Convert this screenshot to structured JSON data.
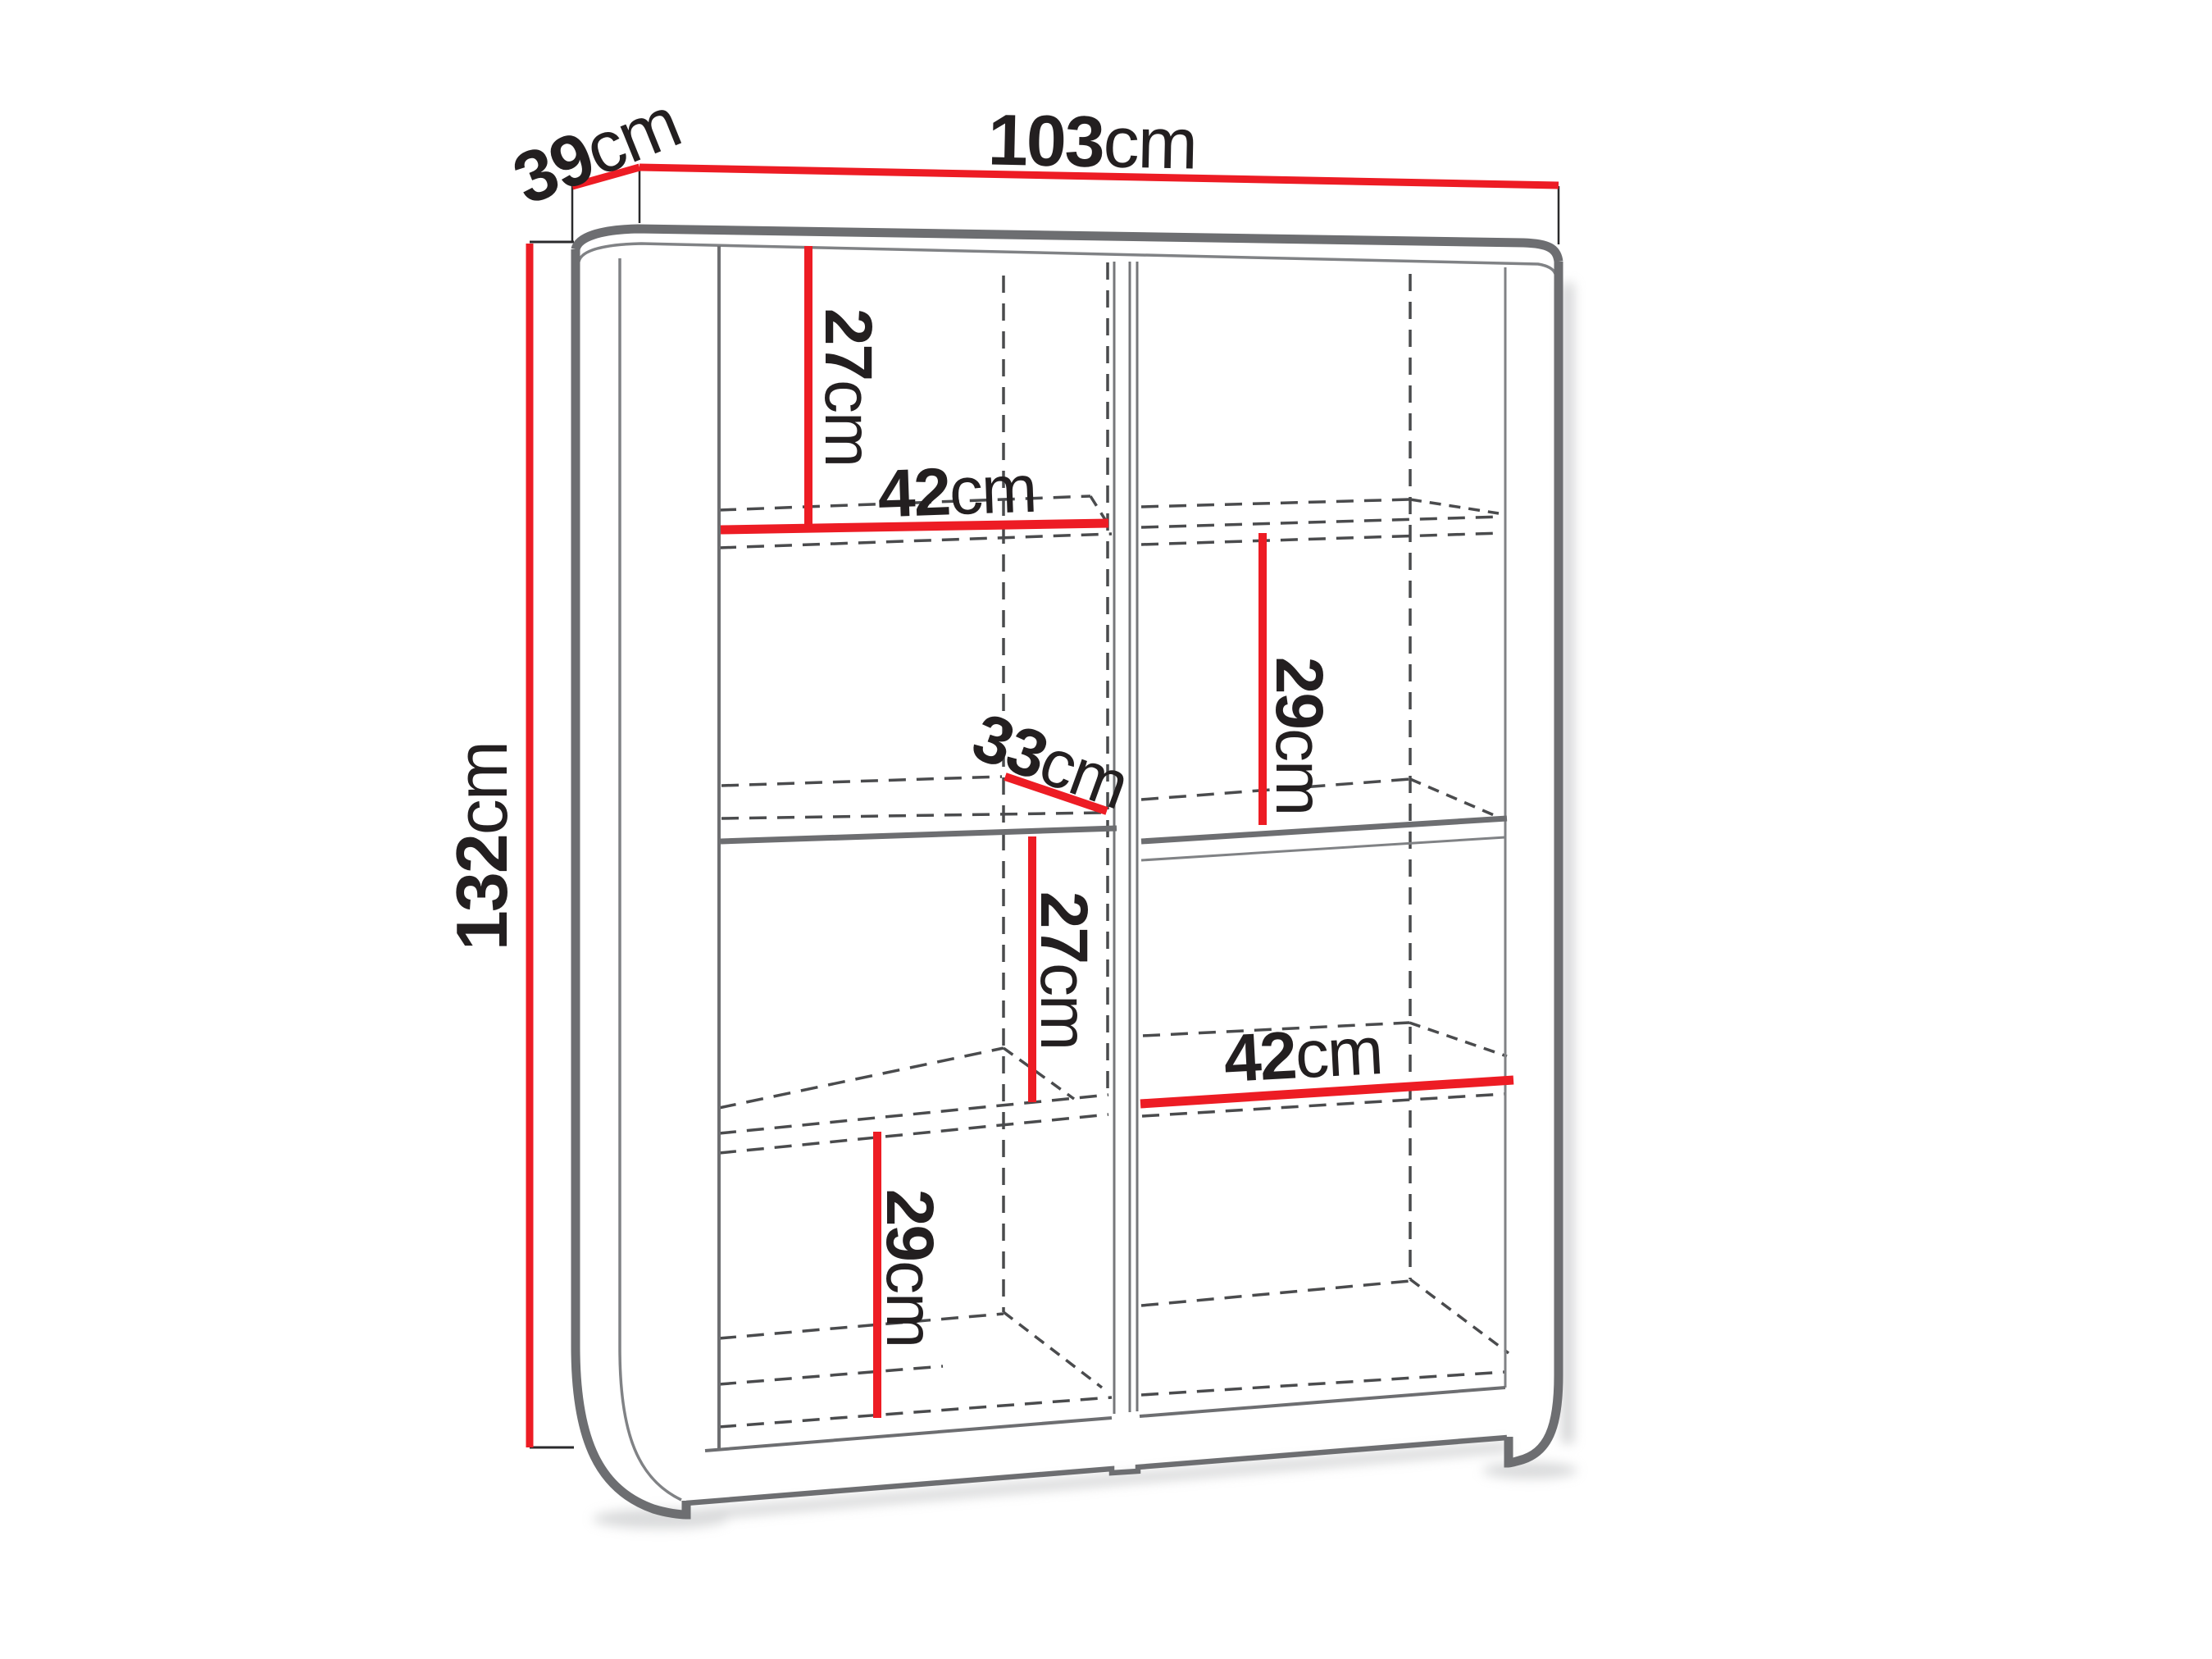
{
  "diagram": {
    "kind": "furniture dimension drawing",
    "object": "two-door display cabinet shown in three-quarter view with shelf measurements",
    "colors": {
      "dimension_line": "#ed1c24",
      "outline_gray": "#6d6e71",
      "hidden_edge_gray": "#4a4b4d",
      "text": "#231f20",
      "background": "#ffffff"
    },
    "dimensions": {
      "depth": {
        "value": "39",
        "unit": "cm"
      },
      "width": {
        "value": "103",
        "unit": "cm"
      },
      "height": {
        "value": "132",
        "unit": "cm"
      },
      "left_top_compartment": {
        "value": "27",
        "unit": "cm"
      },
      "left_shelf_width": {
        "value": "42",
        "unit": "cm"
      },
      "shelf_depth": {
        "value": "33",
        "unit": "cm"
      },
      "right_upper_compartment": {
        "value": "29",
        "unit": "cm"
      },
      "left_middle_compartment": {
        "value": "27",
        "unit": "cm"
      },
      "right_shelf_width": {
        "value": "42",
        "unit": "cm"
      },
      "left_bottom_compartment": {
        "value": "29",
        "unit": "cm"
      }
    }
  }
}
